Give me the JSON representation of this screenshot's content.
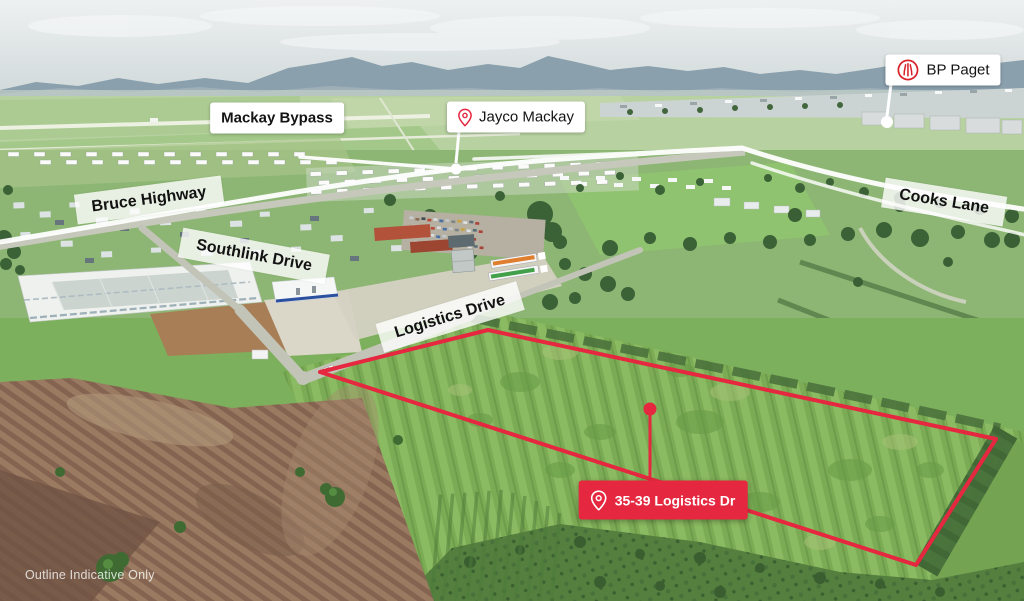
{
  "labels": {
    "mackay_bypass": "Mackay Bypass",
    "bruce_highway": "Bruce Highway",
    "southlink_drive": "Southlink Drive",
    "logistics_drive": "Logistics Drive",
    "cooks_lane": "Cooks Lane",
    "jayco": "Jayco Mackay",
    "bp": "BP Paget",
    "site_badge": "35-39 Logistics Dr",
    "disclaimer": "Outline Indicative Only"
  },
  "icons": {
    "jayco_pin": "location-pin-icon",
    "bp_logo": "bp-helios-logo-icon",
    "site_pin": "location-pin-icon"
  },
  "colors": {
    "accent_red": "#E5283F",
    "label_bg": "#FFFFFF",
    "road_label_bg": "rgba(255,255,255,0.8)",
    "label_text": "#141414",
    "badge_text": "#FFFFFF",
    "leader_line": "#FFFFFF"
  }
}
